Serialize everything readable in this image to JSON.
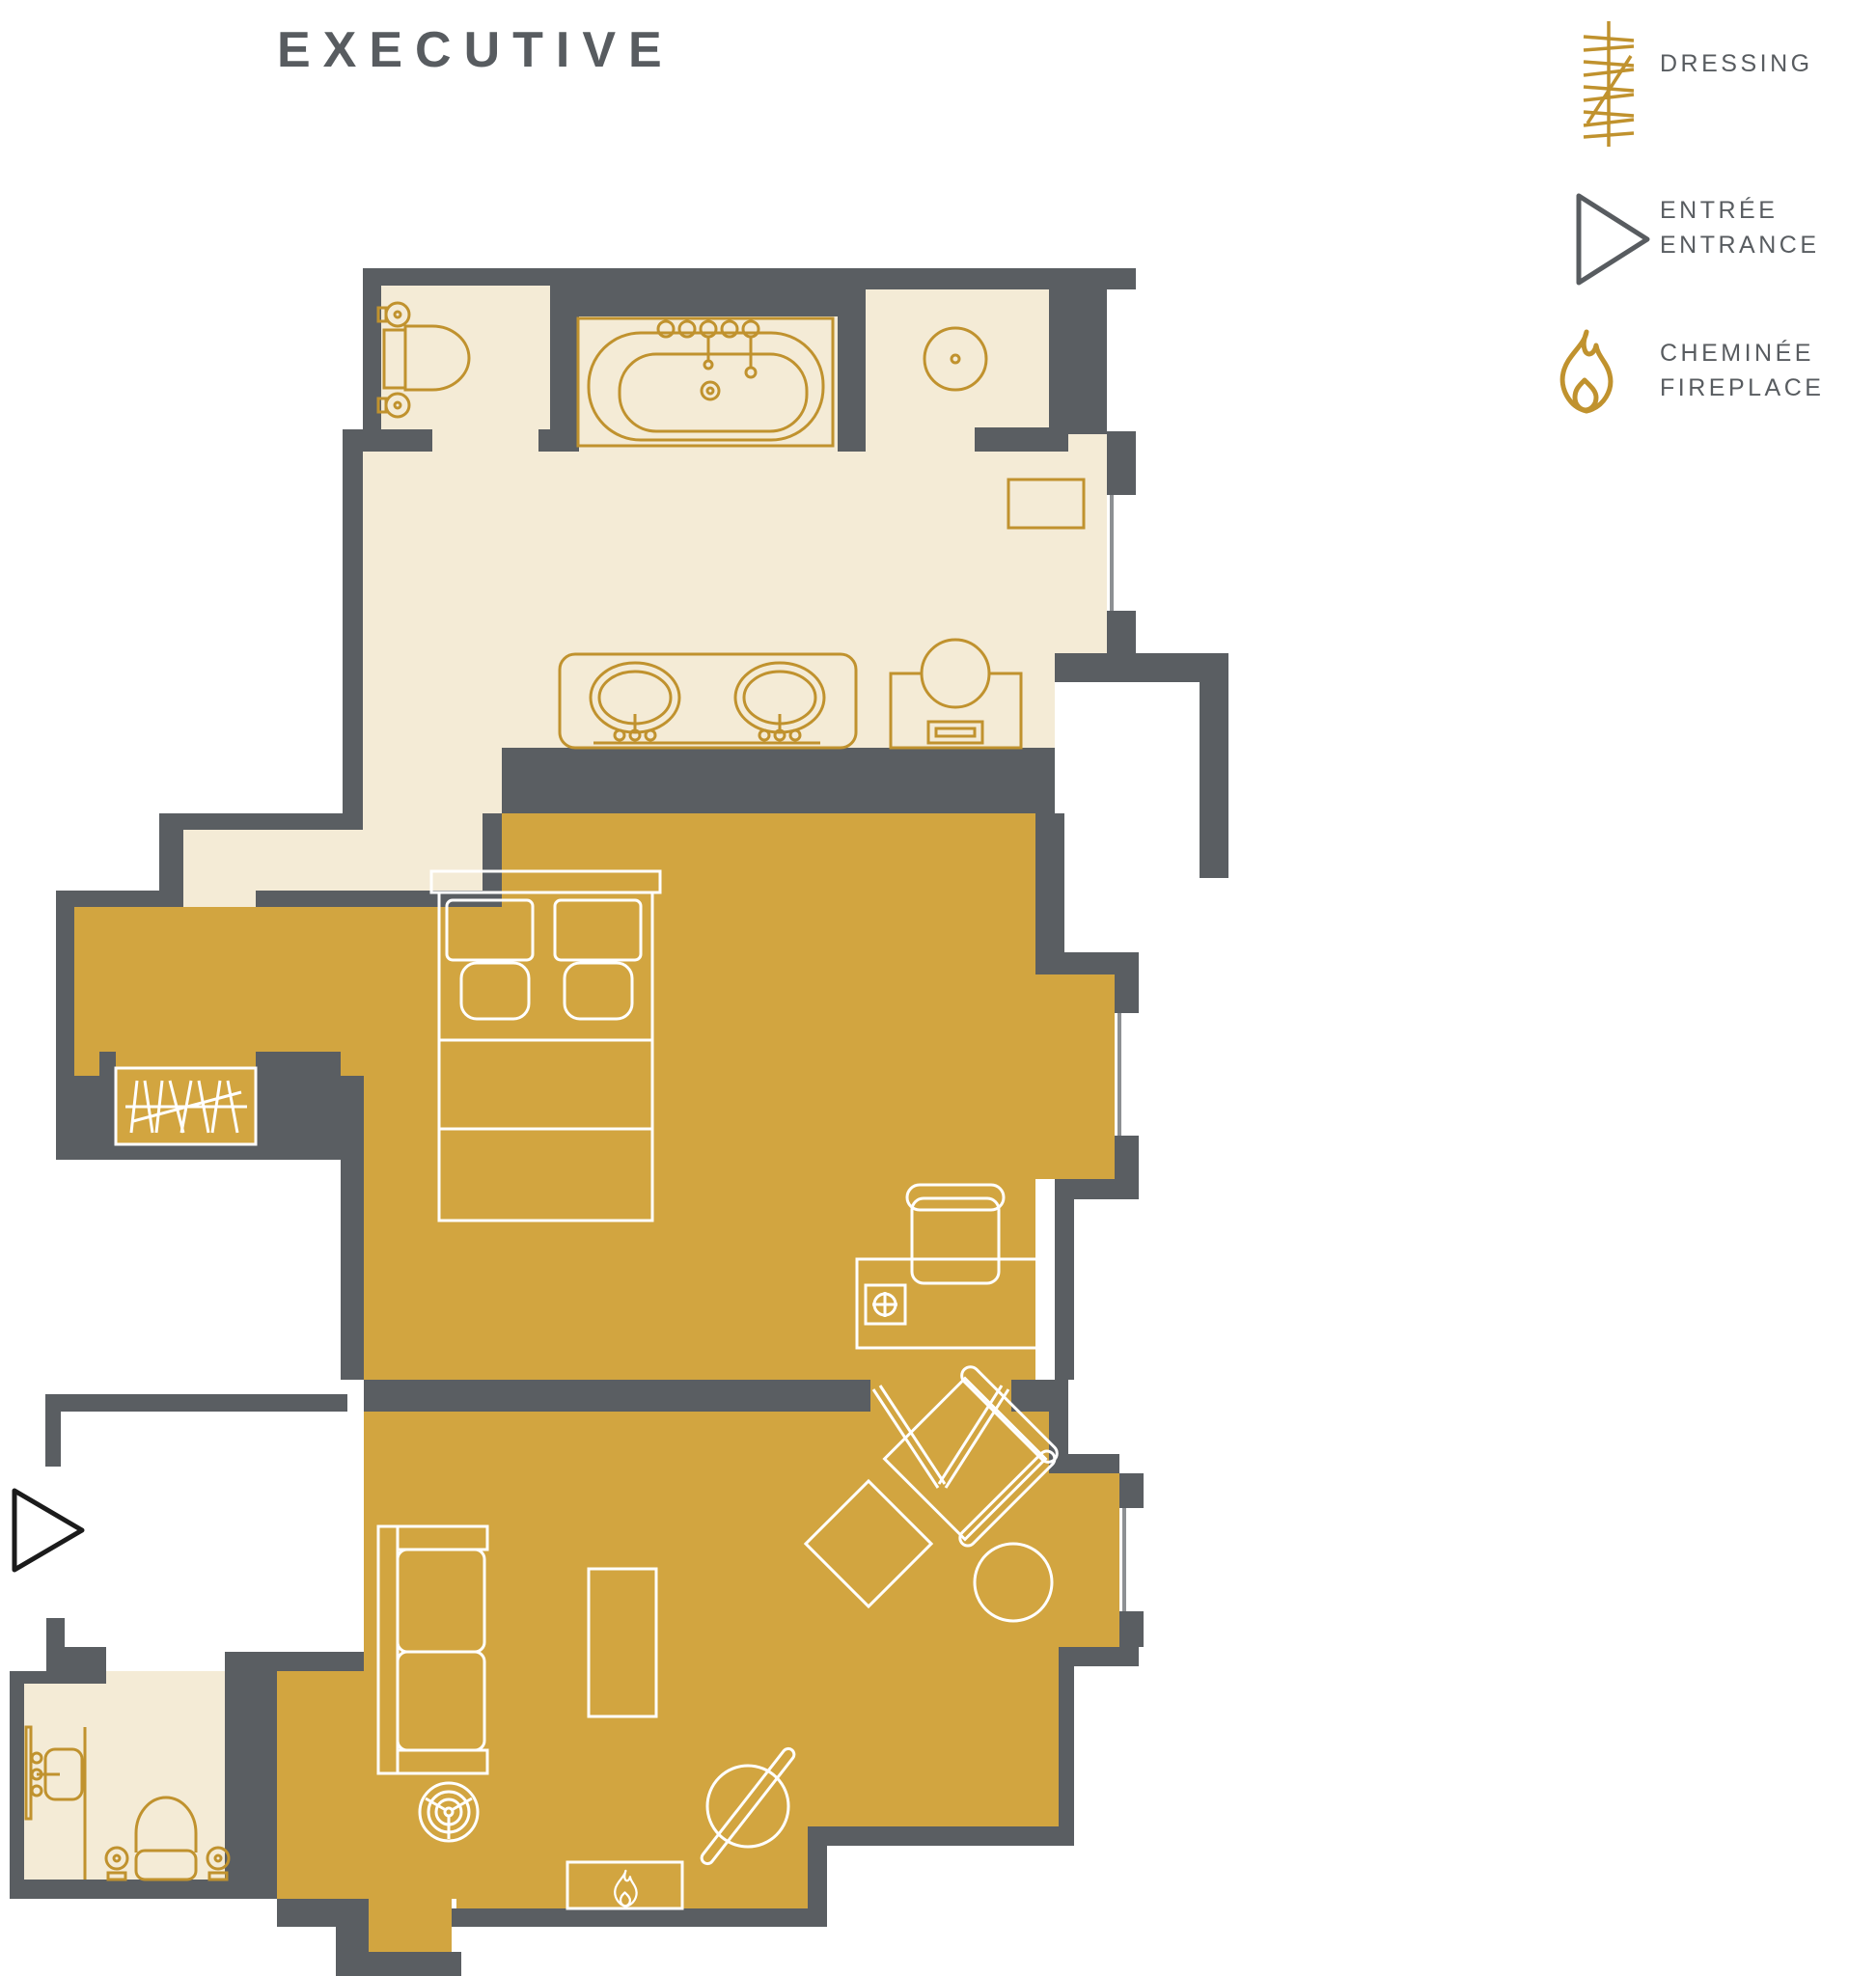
{
  "title": "EXECUTIVE",
  "legend": {
    "items": [
      {
        "id": "dressing",
        "icon": "dressing-hatch-icon",
        "labels": [
          "DRESSING"
        ]
      },
      {
        "id": "entrance",
        "icon": "entrance-triangle-icon",
        "labels": [
          "ENTRÉE",
          "ENTRANCE"
        ]
      },
      {
        "id": "fireplace",
        "icon": "fireplace-flame-icon",
        "labels": [
          "CHEMINÉE",
          "FIREPLACE"
        ]
      }
    ]
  },
  "colors": {
    "wall": "#5a5e62",
    "cream": "#f4ebd6",
    "gold": "#d2a540",
    "goldline": "#c0922e",
    "text": "#585c60"
  },
  "floor_plan": {
    "zones": [
      "bathroom-suite",
      "bedroom",
      "living-room",
      "guest-bathroom",
      "entry-corridor",
      "dressing-closet"
    ],
    "furniture": [
      "toilet",
      "bathtub",
      "double-vanity-sinks",
      "shower",
      "washstand",
      "cabinet",
      "double-bed",
      "desk",
      "desk-chair",
      "sofa",
      "floor-lamp",
      "coffee-table",
      "armchair",
      "ottoman",
      "side-table",
      "round-table",
      "fireplace",
      "guest-toilet",
      "guest-washbasin"
    ],
    "markers": [
      "entrance-triangle",
      "fireplace-flame",
      "dressing-hatch"
    ],
    "windows": 3
  }
}
